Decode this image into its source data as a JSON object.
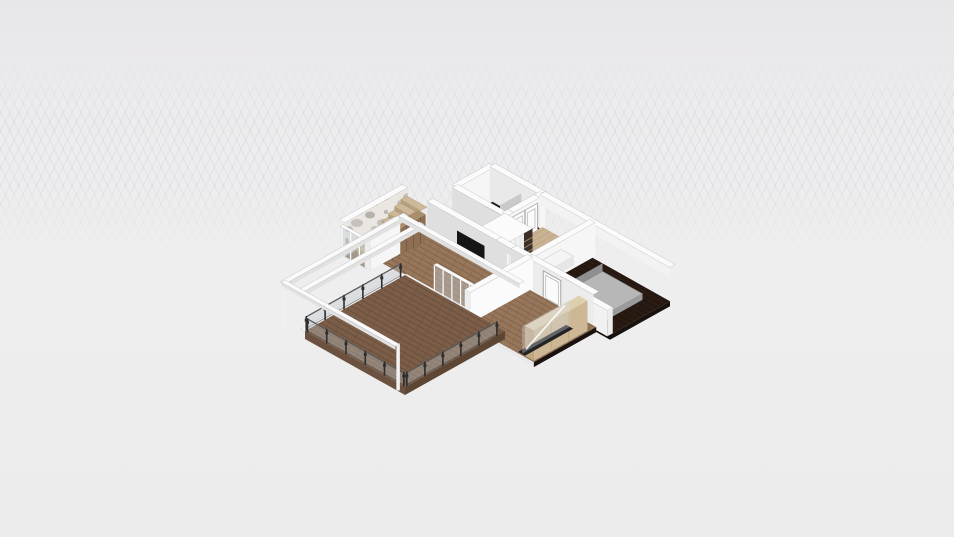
{
  "viewport": {
    "type": "3d-home-design-render-viewport",
    "background": "#ecebed",
    "model": "single-storey apartment floor plan, axonometric view, open ceilings"
  },
  "scene": {
    "parts": [
      "bathroom-dark-floor",
      "bathroom-double-door",
      "wardrobe-closet-sliding-doors",
      "hallway-light-wood-floor",
      "bedroom-dark-floor",
      "bed-gray",
      "white-sideboard",
      "stair-room-accent-wall",
      "staircase-wood",
      "kitchen-tall-cabinets",
      "tv-panel",
      "living-room-wood-floor",
      "glass-sliding-doors",
      "terrace-wood-deck",
      "terrace-glass-railing",
      "pergola-white-frame",
      "front-room-wood-floor",
      "front-room-white-door",
      "beige-wardrobe",
      "glass-partition"
    ],
    "colors": {
      "bg": "#ecebed",
      "grid": "rgba(150,150,162,0.16)",
      "wood": "#97775b",
      "wood_gap": "#846549",
      "terrace": "#7c5e48",
      "terrace_gap": "#68503c",
      "beige": "#cab394",
      "beige_gap": "#bda783",
      "dark_floor": "#251811",
      "dark_floor_gap": "#2f1e14",
      "wall_light": "#f6f6f6",
      "wall_shade": "#dfdfdf",
      "wall_top": "#fbfbfb",
      "wall_side": "#ededed",
      "wall_edge": "rgba(110,110,115,0.35)",
      "beam_top": "#fafafa",
      "beam_side": "#e1e1e1",
      "glass": "rgba(196,206,211,0.42)",
      "mullion": "#fbfbfb",
      "rail_post": "#2e2e2e",
      "rail_bar": "#5a5a5a",
      "marble_base": "#eae7e2",
      "marble_vein": "#a9a4a0",
      "marble_vein2": "#c6c1bc",
      "cabinet": "#8d7054",
      "cabinet_gap": "#755b42",
      "shelf_dark": "#3a3028",
      "shelf_wood": "#9c7b5a",
      "stair": "#cdb897",
      "stair_side": "#b5a07f",
      "tv": "#151515",
      "bed_top": "#b7b7b7",
      "bed_side": "#9b9b9b",
      "bed_head": "#8f8f8f",
      "door_face": "#fbfbfb",
      "door_frame": "#a6a6a6",
      "wardrobe": "#cdb794",
      "wardrobe_top": "#ded0af",
      "wardrobe_side": "#bfa77e",
      "fascia_dark": "#1a120e",
      "track_dark": "#232323",
      "partition_gray": "#c9c9c9",
      "desk_white": "#f4f4f4"
    }
  }
}
